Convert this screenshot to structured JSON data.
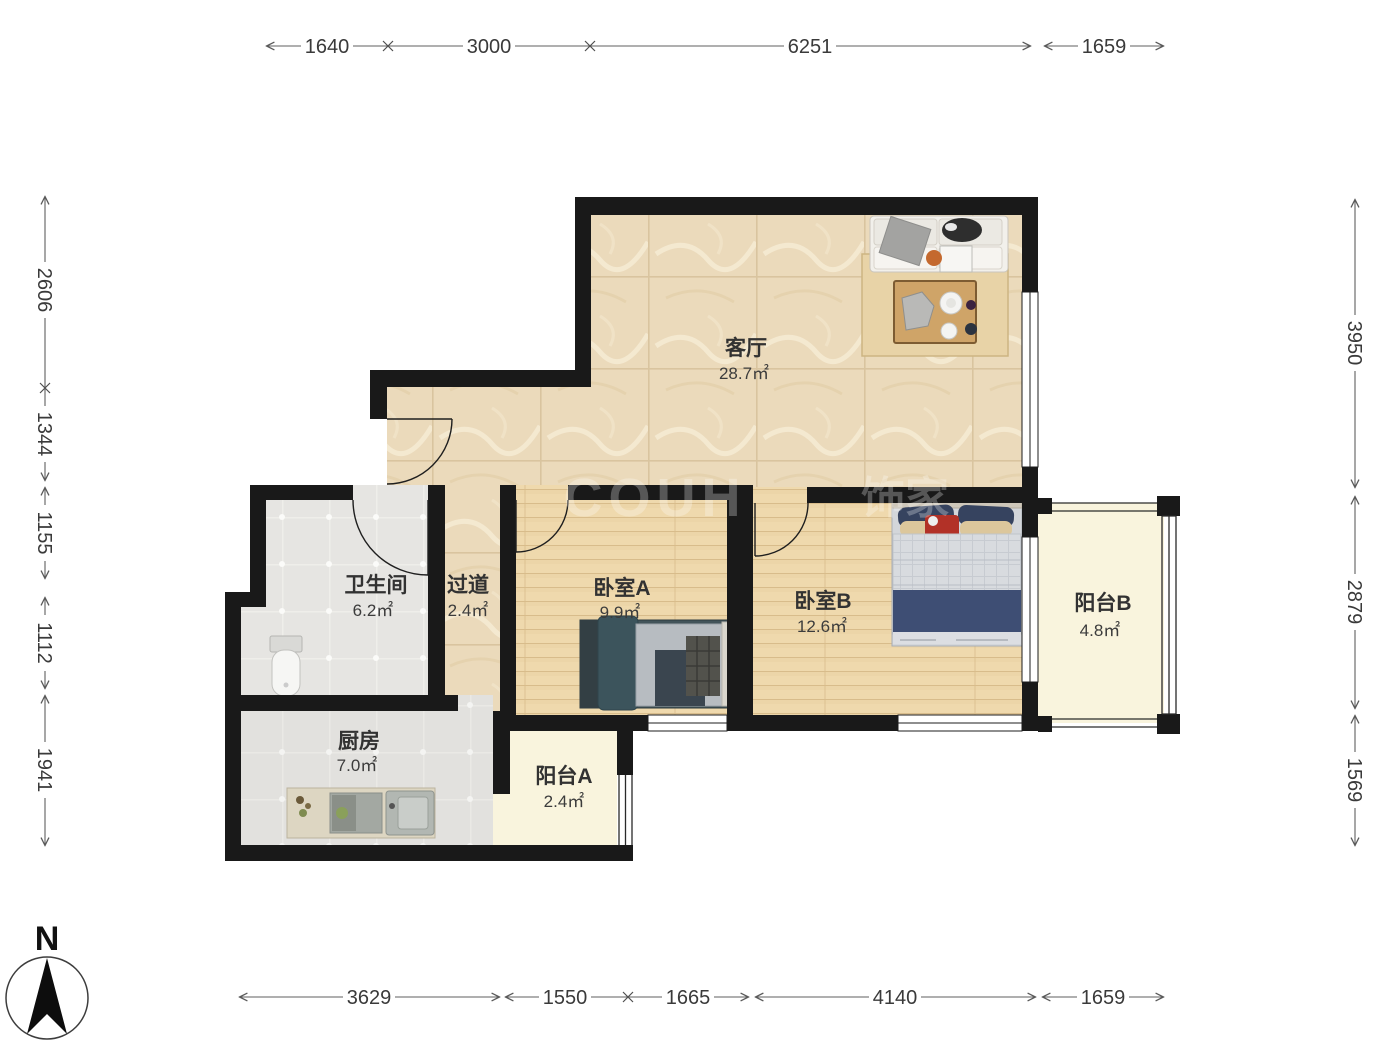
{
  "compass": {
    "label": "N"
  },
  "watermark": {
    "latin": "COUH",
    "cn": "饰家"
  },
  "rooms": {
    "living": {
      "name": "客厅",
      "area": "28.7㎡"
    },
    "bedroomA": {
      "name": "卧室A",
      "area": "9.9㎡"
    },
    "bedroomB": {
      "name": "卧室B",
      "area": "12.6㎡"
    },
    "bathroom": {
      "name": "卫生间",
      "area": "6.2㎡"
    },
    "hallway": {
      "name": "过道",
      "area": "2.4㎡"
    },
    "kitchen": {
      "name": "厨房",
      "area": "7.0㎡"
    },
    "balconyA": {
      "name": "阳台A",
      "area": "2.4㎡"
    },
    "balconyB": {
      "name": "阳台B",
      "area": "4.8㎡"
    }
  },
  "dimensions": {
    "top": [
      "1640",
      "3000",
      "6251",
      "1659"
    ],
    "bottom": [
      "3629",
      "1550",
      "1665",
      "4140",
      "1659"
    ],
    "left": [
      "2606",
      "1344",
      "1155",
      "1112",
      "1941"
    ],
    "right": [
      "3950",
      "2879",
      "1569"
    ]
  },
  "colors": {
    "wall": "#191919",
    "marble_floor": "#ebdabb",
    "wood_floor": "#efd9ad",
    "tile_floor": "#e6e5e2",
    "balcony_floor": "#f9f4dd"
  }
}
